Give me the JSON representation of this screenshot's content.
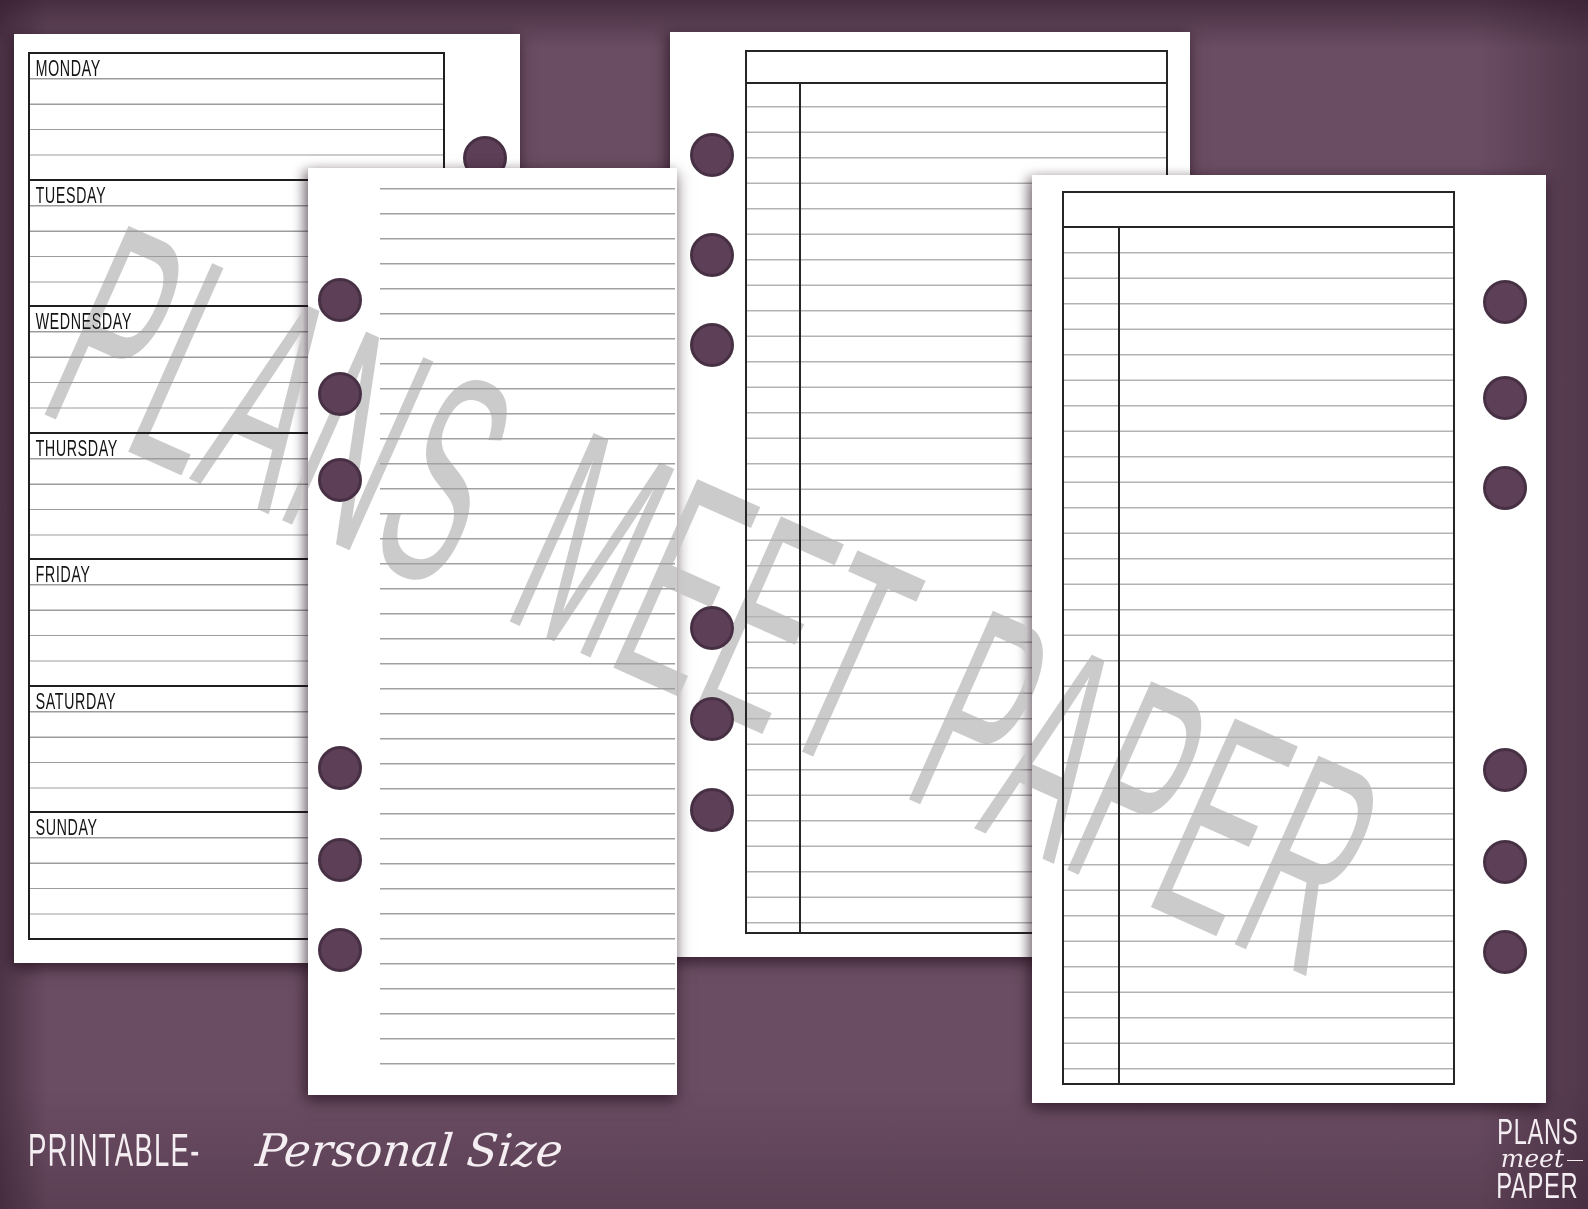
{
  "watermark": "PLANS MEET PAPER",
  "weekly": {
    "days": [
      "MONDAY",
      "TUESDAY",
      "WEDNESDAY",
      "THURSDAY",
      "FRIDAY",
      "SATURDAY",
      "SUNDAY"
    ],
    "rows_per_day": 5
  },
  "notes_page": {
    "line_count": 36
  },
  "ledger_left_page": {
    "row_count": 34,
    "header_rows": 1,
    "columns": 2
  },
  "ledger_right_page": {
    "row_count": 35,
    "header_rows": 1,
    "columns": 2
  },
  "footer": {
    "printable_label": "PRINTABLE-",
    "size_label": "Personal Size"
  },
  "logo": {
    "line1": "PLANS",
    "line2": "meet",
    "line3": "PAPER"
  },
  "colors": {
    "background": "#6b4d63",
    "paper": "#ffffff",
    "weekly_border": "#1f1f1f",
    "ledger_border": "#262626",
    "weekly_rule": "#9c9c9c",
    "notes_rule": "#a0a0a0",
    "ledger_rule": "#b3b3b3",
    "hole_fill": "#5d3f57",
    "hole_border": "#473044",
    "watermark": "#c7c7c7",
    "footer_text": "#f4eef2"
  }
}
